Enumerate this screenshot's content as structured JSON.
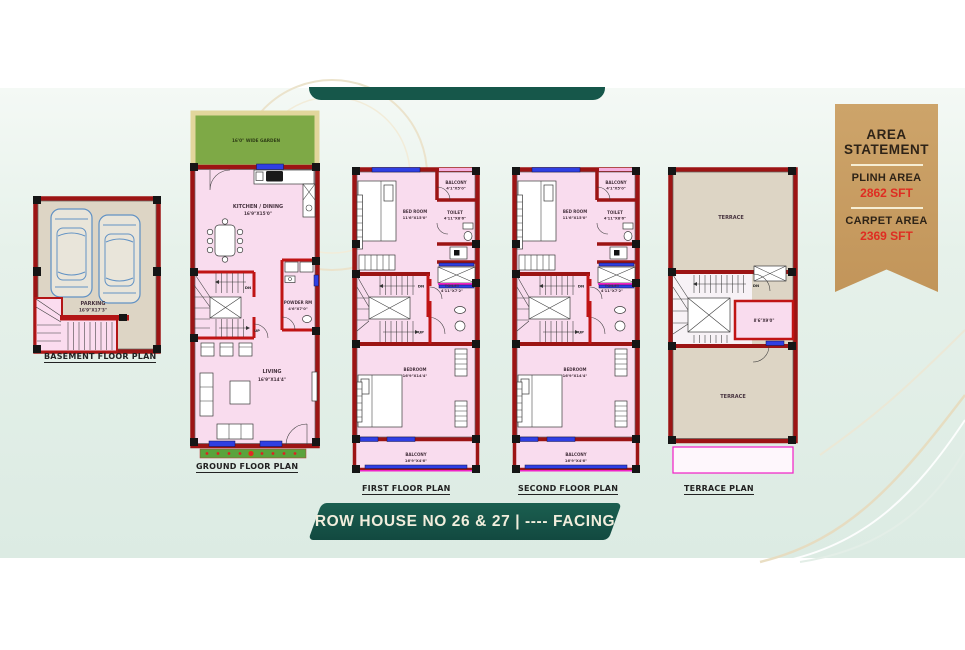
{
  "ribbon": {
    "title_line1": "AREA",
    "title_line2": "STATEMENT",
    "rows": [
      {
        "label": "PLINH AREA",
        "value": "2862 SFT"
      },
      {
        "label": "CARPET AREA",
        "value": "2369 SFT"
      }
    ]
  },
  "plans": {
    "basement": {
      "label": "BASEMENT FLOOR PLAN",
      "parking_name": "PARKING",
      "parking_dim": "16'9\"X17'3\""
    },
    "ground": {
      "label": "GROUND FLOOR PLAN",
      "garden_label": "16'0\" WIDE GARDEN",
      "kitchen_name": "KITCHEN / DINING",
      "kitchen_dim": "16'9\"X15'0\"",
      "powder_name": "POWDER RM",
      "powder_dim": "4'6\"X7'0\"",
      "living_name": "LIVING",
      "living_dim": "16'9\"X14'4\"",
      "dn": "DN",
      "up": "UP"
    },
    "floor_rooms": {
      "balcony_top_name": "BALCONY",
      "balcony_top_dim": "4'1\"X5'0\"",
      "bedroom_top_name": "BED ROOM",
      "bedroom_top_dim": "11'6\"X15'0\"",
      "toilet_top_name": "TOILET",
      "toilet_top_dim": "4'11\"X8'6\"",
      "toilet_mid_name": "TOILET",
      "toilet_mid_dim": "4'11\"X7'2\"",
      "bedroom_bottom_name": "BEDROOM",
      "bedroom_bottom_dim": "16'9\"X14'4\"",
      "balcony_bottom_name": "BALCONY",
      "balcony_bottom_dim": "16'9\"X4'6\"",
      "dn": "DN",
      "up": "UP"
    },
    "first": {
      "label": "FIRST FLOOR PLAN"
    },
    "second": {
      "label": "SECOND FLOOR PLAN"
    },
    "terrace": {
      "label": "TERRACE PLAN",
      "terrace_upper": "TERRACE",
      "terrace_lower": "TERRACE",
      "headroom_dim": "8'6\"X9'0\"",
      "dn": "DN"
    }
  },
  "footer": {
    "banner_text": "ROW HOUSE NO 26 & 27 | ---- FACING"
  },
  "colors": {
    "brand_green": "#16574a",
    "ribbon_tan": "#c89e63",
    "value_red": "#df2d22",
    "wall_red": "#9c1414",
    "room_pink": "#f9dcee",
    "window_blue": "#2f3fe3",
    "terrace_beige": "#ddd5c5",
    "garden_green": "#7ea946",
    "accent_magenta": "#f023c8"
  }
}
